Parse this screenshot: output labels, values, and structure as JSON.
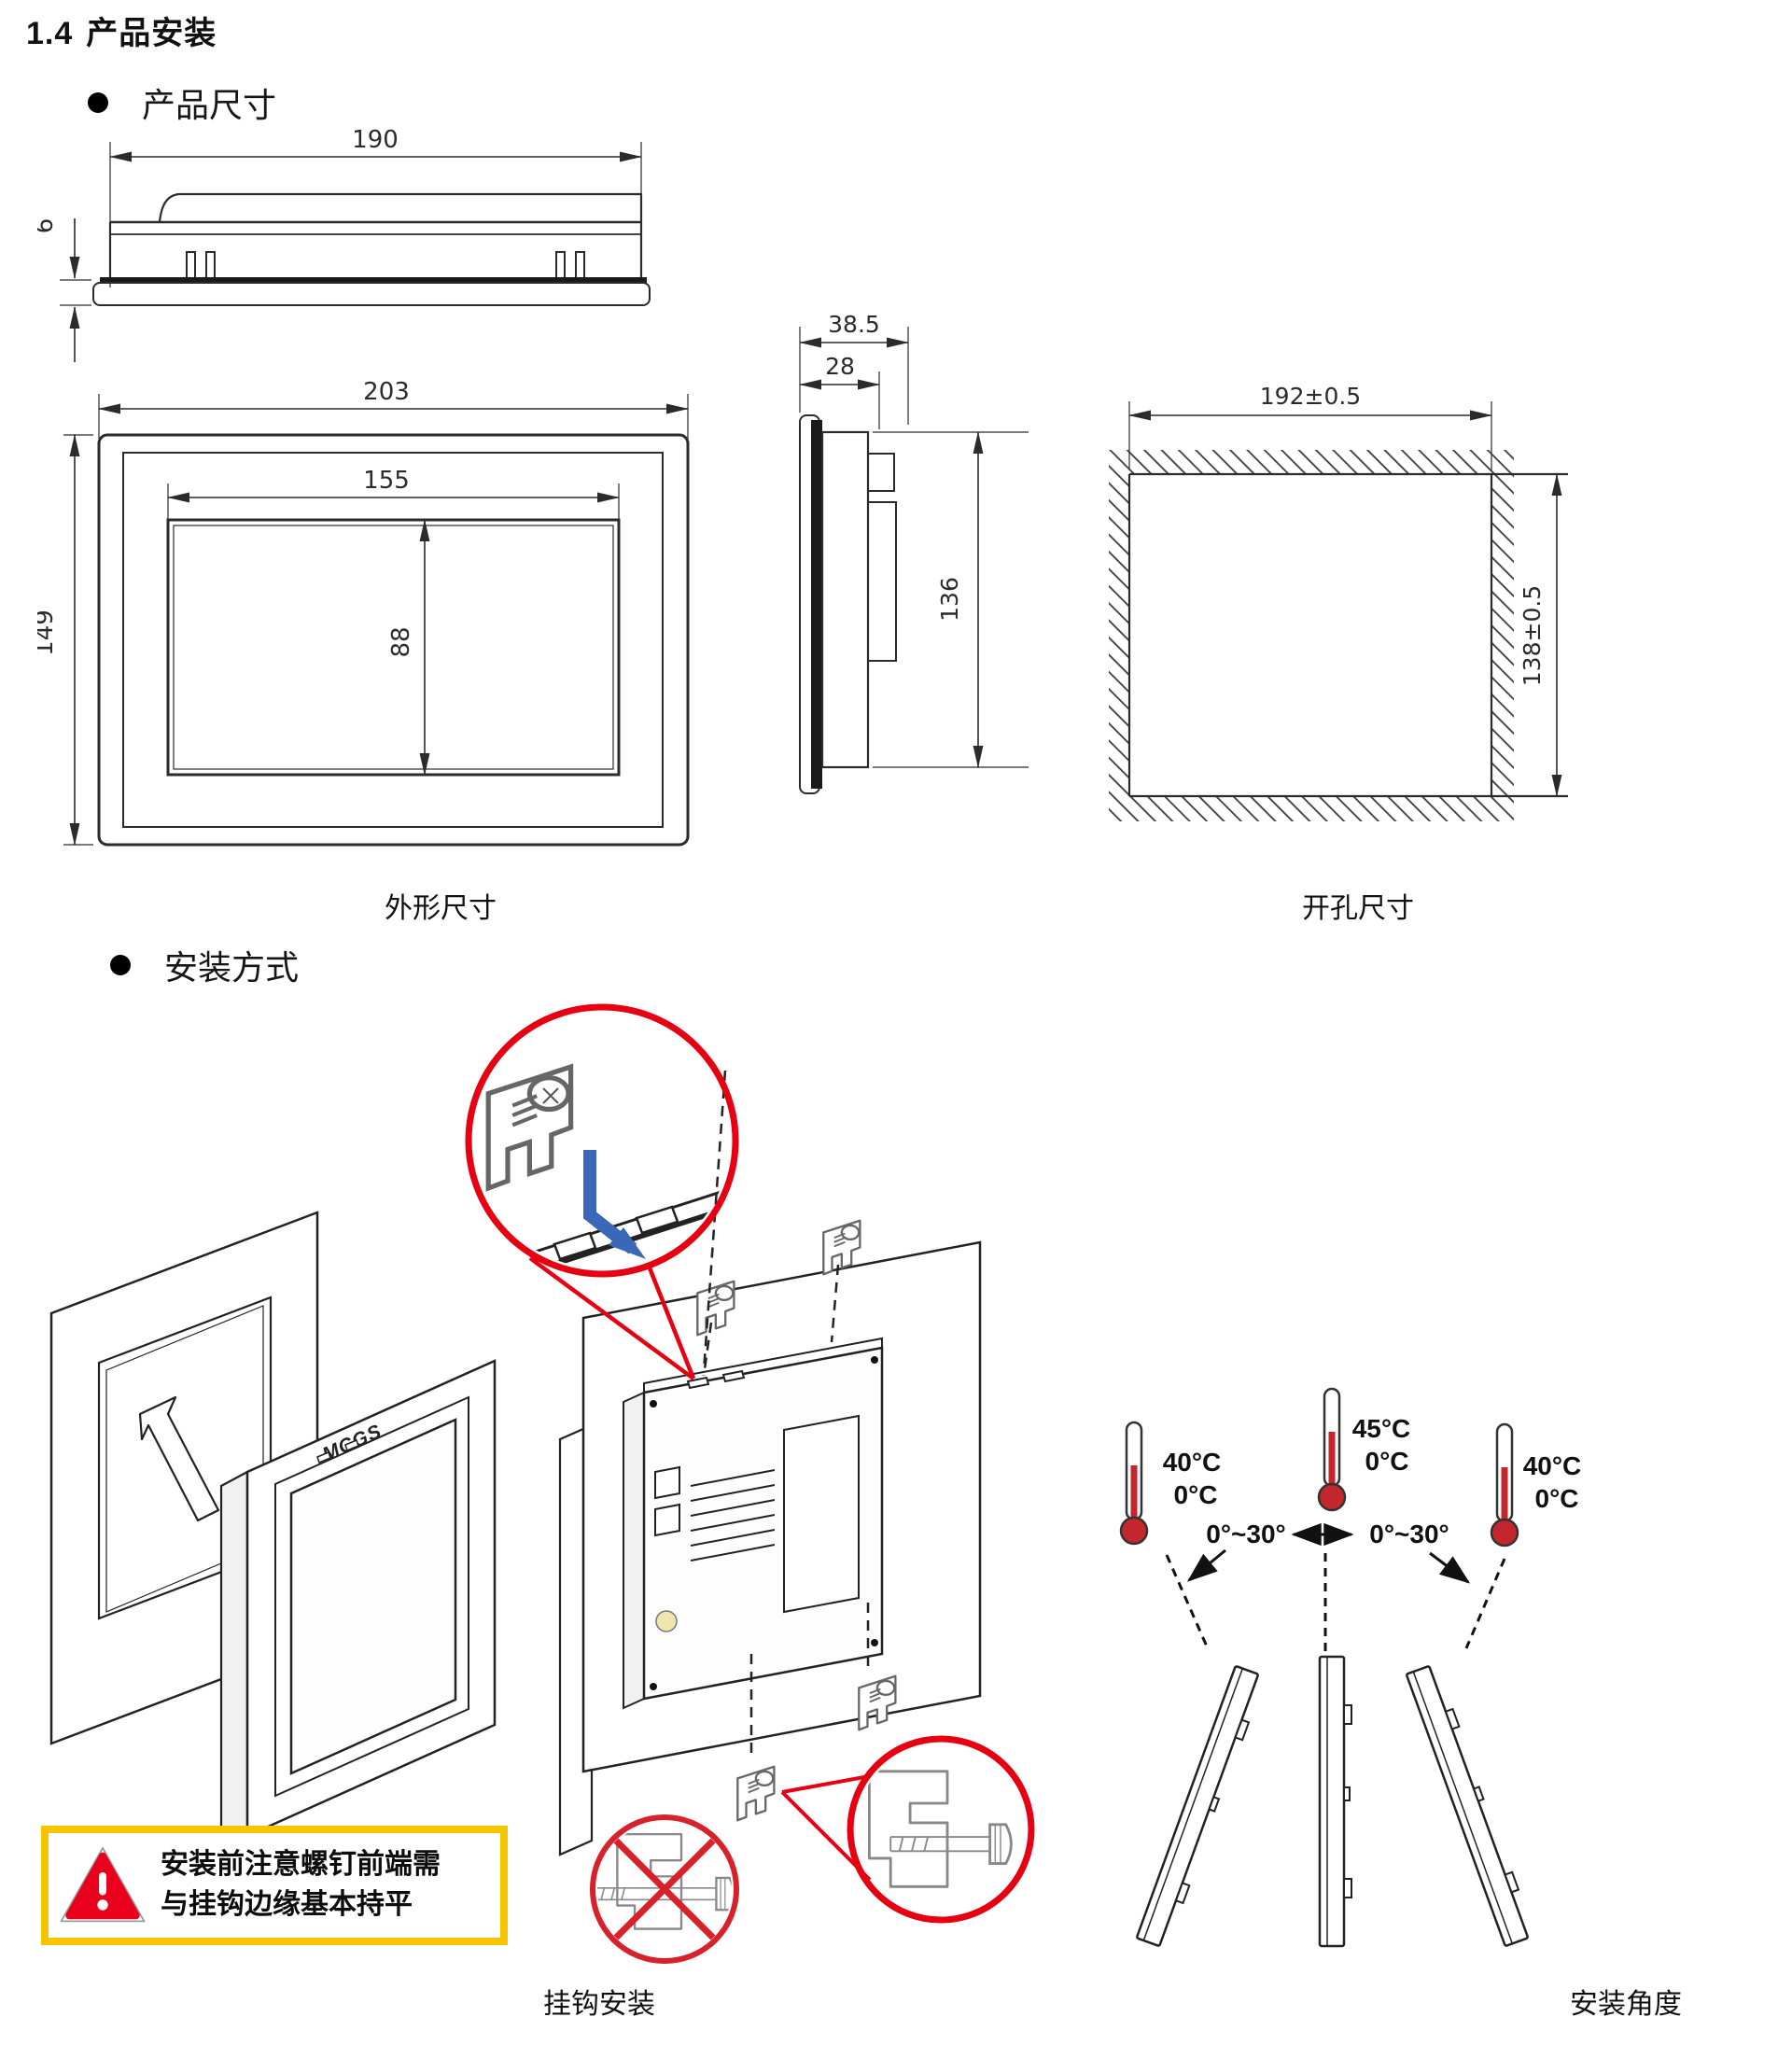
{
  "page": {
    "section_number": "1.4",
    "section_title": "产品安装",
    "bullets": {
      "product_size": "产品尺寸",
      "install_method": "安装方式"
    }
  },
  "outline_figure": {
    "caption": "外形尺寸",
    "top_view": {
      "width": "190",
      "front_thickness": "6"
    },
    "front_view": {
      "outer_width": "203",
      "display_width": "155",
      "outer_height": "149",
      "display_height": "88"
    },
    "side_view": {
      "depth_total": "38.5",
      "depth_body": "28",
      "body_height": "136"
    }
  },
  "cutout_figure": {
    "caption": "开孔尺寸",
    "width": "192±0.5",
    "height": "138±0.5"
  },
  "hook_figure": {
    "caption": "挂钩安装",
    "device_logo": "MCGS",
    "warning": {
      "line1": "安装前注意螺钉前端需",
      "line2": "与挂钩边缘基本持平"
    }
  },
  "angle_figure": {
    "caption": "安装角度",
    "left_thermometer": {
      "max": "40°C",
      "min": "0°C"
    },
    "center_thermometer": {
      "max": "45°C",
      "min": "0°C"
    },
    "right_thermometer": {
      "max": "40°C",
      "min": "0°C"
    },
    "tilt_range_left": "0°~30°",
    "tilt_range_right": "0°~30°"
  },
  "colors": {
    "callout_red": "#e60012",
    "insert_arrow_blue": "#3a67b8",
    "warning_border_yellow": "#f7c500",
    "warning_triangle_red": "#e8001d",
    "thermometer_red": "#c4262e",
    "drawing_line": "#2b2b2b"
  }
}
